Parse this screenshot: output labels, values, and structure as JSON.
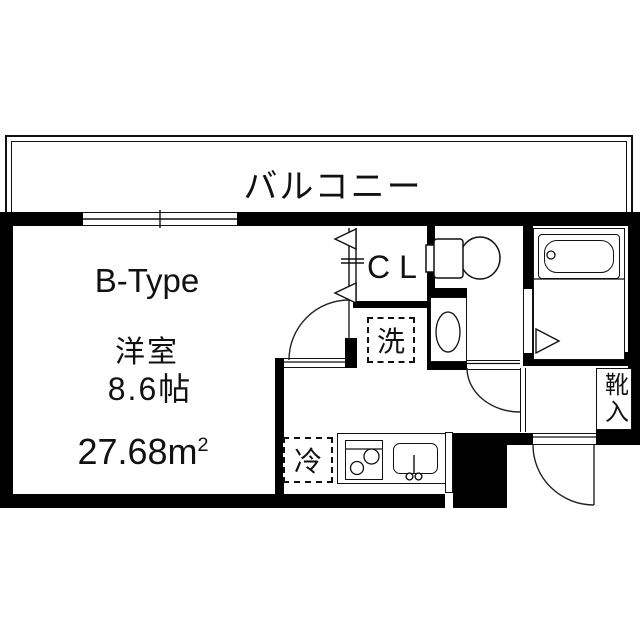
{
  "plan": {
    "balcony_label": "バルコニー",
    "unit_type": "B-Type",
    "room_name": "洋室",
    "room_size": "8.6帖",
    "area_value": "27.68",
    "area_unit_base": "m",
    "area_unit_exp": "2",
    "closet_label": "CL",
    "washer_label": "洗",
    "fridge_label": "冷",
    "shoe_cabinet_label": "靴入",
    "colors": {
      "wall": "#000000",
      "line": "#111111",
      "bg": "#ffffff"
    },
    "icons": [
      "window-icon",
      "door-swing-icon",
      "folding-door-icon",
      "toilet-icon",
      "washbasin-icon",
      "bathtub-icon",
      "stove-icon",
      "kitchen-sink-icon",
      "faucet-icon"
    ]
  }
}
